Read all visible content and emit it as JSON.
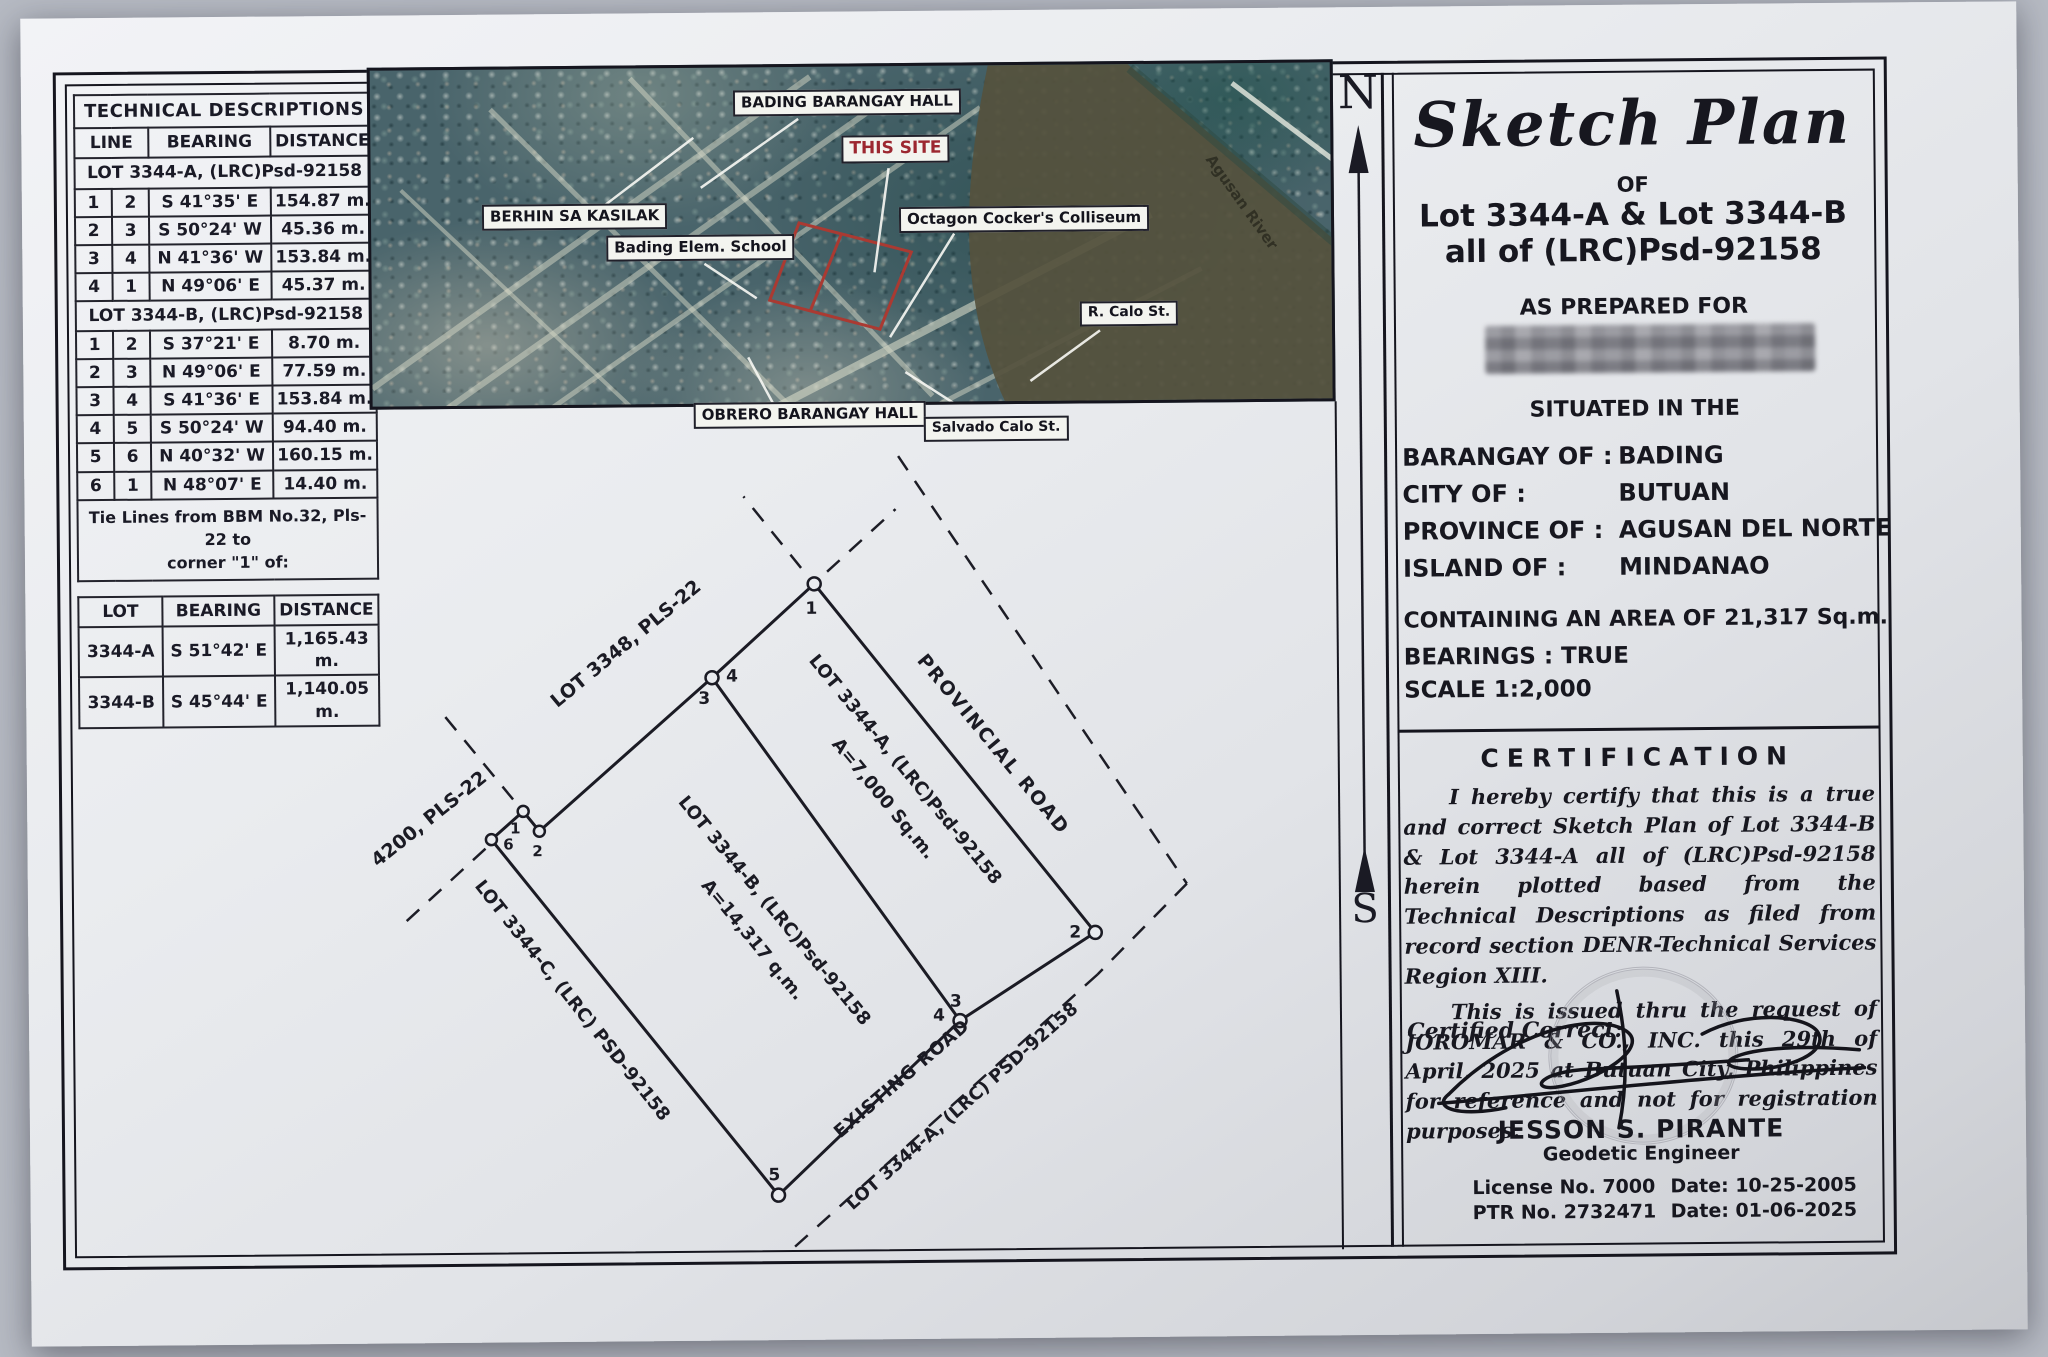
{
  "colors": {
    "ink": "#15151e",
    "this_site": "#9c2730",
    "site_outline": "#aa3a32",
    "paper": "#e9ebef"
  },
  "tech": {
    "title": "TECHNICAL DESCRIPTIONS",
    "col_line": "LINE",
    "col_bearing": "BEARING",
    "col_distance": "DISTANCE",
    "lotA_header": "LOT 3344-A, (LRC)Psd-92158",
    "lotA_rows": [
      [
        "1",
        "2",
        "S 41°35' E",
        "154.87 m."
      ],
      [
        "2",
        "3",
        "S 50°24' W",
        "45.36 m."
      ],
      [
        "3",
        "4",
        "N 41°36' W",
        "153.84 m."
      ],
      [
        "4",
        "1",
        "N 49°06' E",
        "45.37 m."
      ]
    ],
    "lotB_header": "LOT 3344-B, (LRC)Psd-92158",
    "lotB_rows": [
      [
        "1",
        "2",
        "S 37°21' E",
        "8.70 m."
      ],
      [
        "2",
        "3",
        "N 49°06' E",
        "77.59 m."
      ],
      [
        "3",
        "4",
        "S 41°36' E",
        "153.84 m."
      ],
      [
        "4",
        "5",
        "S 50°24' W",
        "94.40 m."
      ],
      [
        "5",
        "6",
        "N 40°32' W",
        "160.15 m."
      ],
      [
        "6",
        "1",
        "N 48°07' E",
        "14.40 m."
      ]
    ],
    "tie_note1": "Tie Lines from BBM No.32, Pls-22 to",
    "tie_note2": "corner \"1\" of:",
    "tie_col_lot": "LOT",
    "tie_col_bearing": "BEARING",
    "tie_col_distance": "DISTANCE",
    "tie_rows": [
      [
        "3344-A",
        "S 51°42' E",
        "1,165.43 m."
      ],
      [
        "3344-B",
        "S 45°44' E",
        "1,140.05 m."
      ]
    ]
  },
  "map": {
    "bading_hall": "BADING BARANGAY HALL",
    "this_site": "THIS SITE",
    "berhin": "BERHIN SA KASILAK",
    "elem_school": "Bading Elem. School",
    "octagon": "Octagon Cocker's Colliseum",
    "r_calo": "R. Calo St.",
    "obrero": "OBRERO BARANGAY HALL",
    "salvado": "Salvado Calo St.",
    "river": "Agusan River"
  },
  "compass": {
    "north": "N",
    "south": "S"
  },
  "diagram": {
    "lot3348": "LOT 3348, PLS-22",
    "lot4200": "LOT 4200, PLS-22",
    "lotA_label": "LOT 3344-A, (LRC)Psd-92158",
    "lotA_area": "A=7,000 Sq.m.",
    "lotB_label": "LOT 3344-B, (LRC)Psd-92158",
    "lotB_area": "A=14,317 q.m.",
    "lotC_label": "LOT 3344-C, (LRC) PSD-92158",
    "provincial_road": "PROVINCIAL ROAD",
    "existing_road": "EXISTING ROAD",
    "lotA_road_label": "LOT 3344-A, (LRC) PSD-92158",
    "n1": "1",
    "n2": "2",
    "n3": "3",
    "n4": "4",
    "n5": "5",
    "n6": "6"
  },
  "title_block": {
    "title": "Sketch Plan",
    "of": "OF",
    "lots": "Lot 3344-A & Lot 3344-B",
    "all_of": "all of  (LRC)Psd-92158",
    "prepared": "AS PREPARED FOR",
    "situated": "SITUATED IN THE",
    "rows": [
      {
        "label": "BARANGAY OF :",
        "value": "BADING"
      },
      {
        "label": "CITY OF :",
        "value": "BUTUAN"
      },
      {
        "label": "PROVINCE OF :",
        "value": "AGUSAN DEL NORTE"
      },
      {
        "label": "ISLAND OF :",
        "value": "MINDANAO"
      }
    ],
    "area_line": "CONTAINING AN AREA OF  21,317  Sq.m.",
    "bearings": "BEARINGS : TRUE",
    "scale": "SCALE  1:2,000"
  },
  "certification": {
    "heading": "CERTIFICATION",
    "p1": "I hereby certify that this is a true and correct Sketch Plan of Lot 3344-B & Lot 3344-A all of (LRC)Psd-92158 herein plotted based from the Technical Descriptions as filed from record section DENR-Technical Services Region XIII.",
    "p2": "This is issued thru the request of JOROMAR & CO., INC. this 29th of April, 2025 at Butuan City, Philippines for reference and not for registration purposes.",
    "certified": "Certified Correct:"
  },
  "signature_block": {
    "name": "JESSON S. PIRANTE",
    "title": "Geodetic Engineer",
    "license": "License No. 7000",
    "ptr": "PTR No. 2732471",
    "date1": "Date: 10-25-2005",
    "date2": "Date: 01-06-2025"
  }
}
